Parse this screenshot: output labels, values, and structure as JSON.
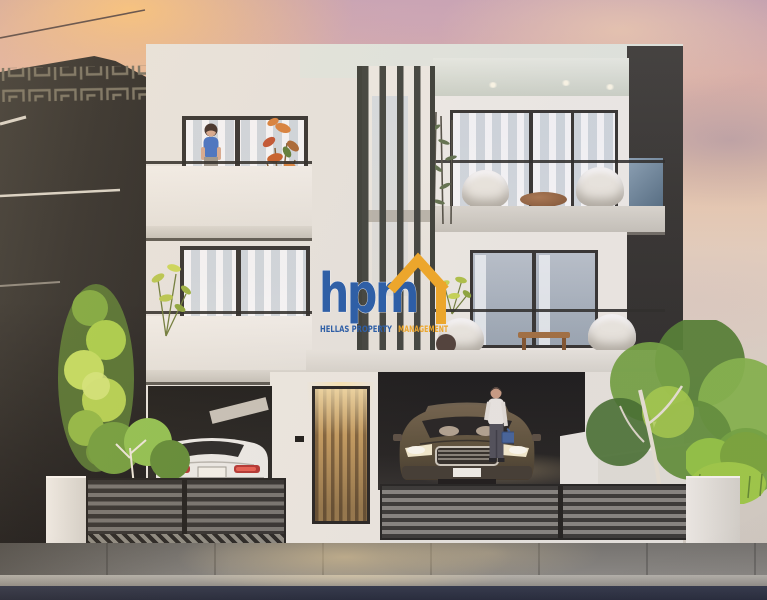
{
  "image": {
    "kind": "architectural exterior rendering photograph",
    "subject": "modern three-storey twin residence at sunset with ground-floor parking, front fences and landscaping",
    "time_of_day": "sunset"
  },
  "watermark": {
    "logo_text": "hpm",
    "tagline_primary": "HELLAS PROPERTY",
    "tagline_accent": "MANAGEMENT",
    "logo_blue": "#1e57a5",
    "logo_orange": "#f2a71d"
  },
  "palette": {
    "sky_pink": "#e6bcae",
    "sky_lavender": "#c9aebc",
    "sunset_glow": "#f6c38c",
    "facade_white": "#e9e6de",
    "dark_charcoal": "#2b2a26",
    "garage_black": "#191916",
    "door_wood": "#b98f52",
    "warm_light": "#f3dba4",
    "street_navy": "#242b3c",
    "sidewalk_gray": "#85847d",
    "foliage_bright": "#a9cf45",
    "foliage_dark": "#4e7a2c",
    "car_gold": "#7d6a4d",
    "car_white": "#eeede7",
    "taillight_red": "#c03a2e",
    "shirt_blue": "#3f6fc2"
  }
}
